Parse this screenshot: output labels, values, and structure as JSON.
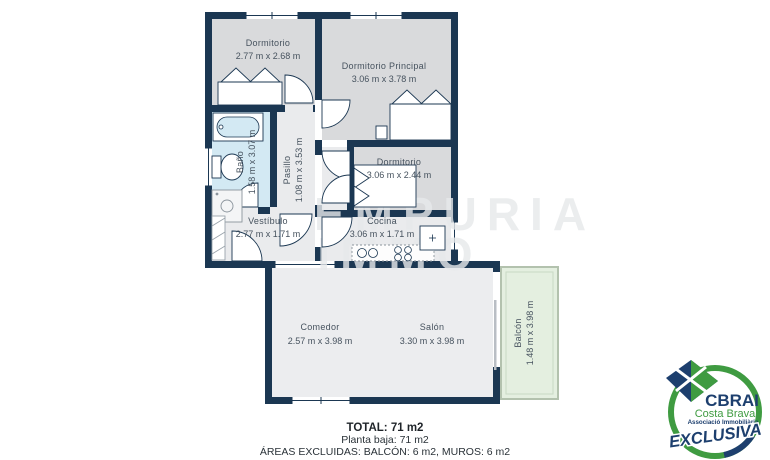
{
  "plan": {
    "rooms": {
      "dorm1": {
        "name": "Dormitorio",
        "dims": "2.77 m x 2.68 m"
      },
      "principal": {
        "name": "Dormitorio Principal",
        "dims": "3.06 m x 3.78 m"
      },
      "bano": {
        "name": "Baño",
        "dims": "1.58 m x 3.07 m"
      },
      "pasillo": {
        "name": "Pasillo",
        "dims": "1.08 m x 3.53 m"
      },
      "dorm3": {
        "name": "Dormitorio",
        "dims": "3.06 m x 2.44 m"
      },
      "vestibulo": {
        "name": "Vestíbulo",
        "dims": "2.77 m x 1.71 m"
      },
      "cocina": {
        "name": "Cocina",
        "dims": "3.06 m x 1.71 m"
      },
      "comedor": {
        "name": "Comedor",
        "dims": "2.57 m x 3.98 m"
      },
      "salon": {
        "name": "Salón",
        "dims": "3.30 m x 3.98 m"
      },
      "balcon": {
        "name": "Balcón",
        "dims": "1.48 m x 3.98 m"
      }
    },
    "watermark": {
      "line1": "EMPURIA",
      "line2": "IMMO"
    }
  },
  "footer": {
    "total": "TOTAL: 71 m2",
    "planta": "Planta baja: 71 m2",
    "areas_excluidas": "ÁREAS EXCLUIDAS: BALCÓN: 6 m2, MUROS: 6 m2"
  },
  "logo": {
    "brand": "CBRAI",
    "region": "Costa Brava",
    "tagline": "Associació Immobiliària",
    "badge": "EXCLUSIVA"
  },
  "colors": {
    "wall": "#1b3752",
    "bedroom_fill": "#d9dadc",
    "light_fill": "#eaebed",
    "bath_fill": "#d3e9f3",
    "balcony_fill": "#e4efe0",
    "label": "#46525e",
    "logo_green": "#3f9b41",
    "logo_blue": "#1d3f6e"
  }
}
